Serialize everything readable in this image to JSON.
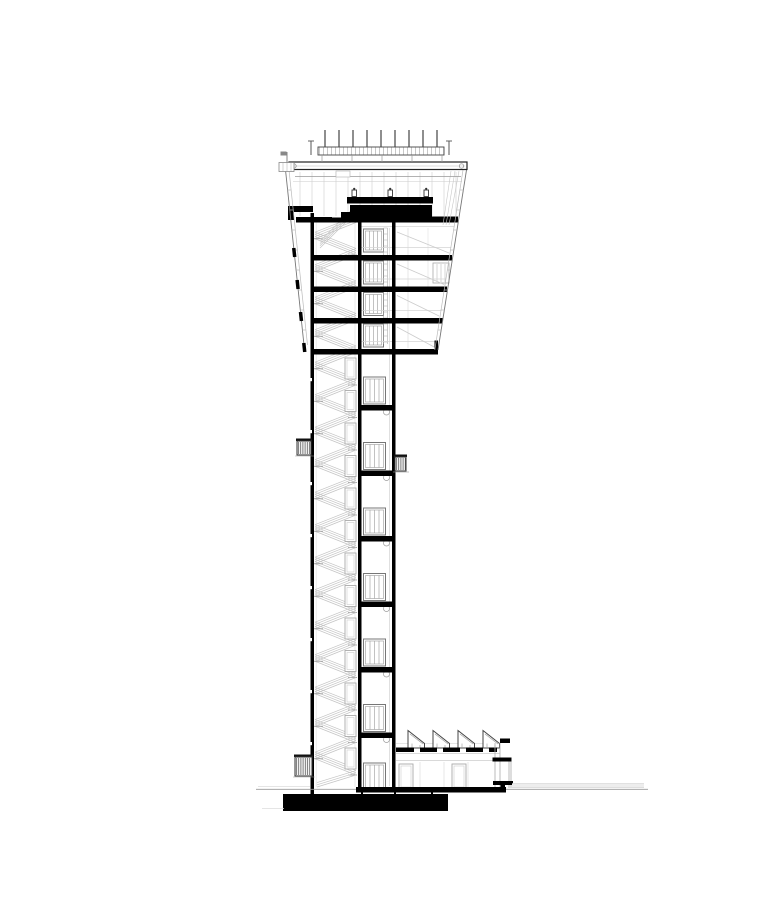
{
  "meta": {
    "description": "Architectural cross-section drawing of an airport air-traffic control tower",
    "drawing_type": "building section elevation",
    "background_color": "#ffffff",
    "ink_color": "#000000"
  },
  "drawing": {
    "canvas": {
      "w": 778,
      "h": 900
    },
    "colors": {
      "ink": "#000000",
      "line": "#333333",
      "mid": "#888888",
      "light": "#bbbbbb",
      "faint": "#dddddd"
    },
    "antenna": {
      "count": 9,
      "x0": 325,
      "dx": 14,
      "y_top": 130,
      "y_bot": 148,
      "band": {
        "x": 318,
        "y": 147,
        "w": 126,
        "h": 8,
        "tick_dx": 4
      },
      "legs": [
        322,
        352,
        382,
        412,
        442
      ],
      "end_posts": [
        311,
        449
      ]
    },
    "cab": {
      "mullion_x0": 300,
      "mullion_dx": 12,
      "mullion_count": 14,
      "mullion_y1": 172,
      "mullion_y2": 216,
      "console_monitors_x": [
        352,
        388,
        424
      ]
    },
    "facades": {
      "left": {
        "x_ref": 285.5,
        "y_ref": 170,
        "slope": 0.1057,
        "y_end": 345,
        "inner_offset": 3.5
      },
      "right": {
        "x_ref": 466.5,
        "y_ref": 170,
        "slope": -0.1583,
        "y_end": 350,
        "inner_offset": -3.5
      },
      "tick_ys": [
        190,
        210,
        230,
        250,
        270,
        290,
        310,
        330
      ]
    },
    "head": {
      "floors": [
        {
          "y": 255,
          "x1": 314,
          "x2": 452
        },
        {
          "y": 286.5,
          "x1": 314,
          "x2": 447
        },
        {
          "y": 318,
          "x1": 314,
          "x2": 442.5
        },
        {
          "y": 349,
          "x1": 314,
          "x2": 438
        }
      ],
      "elevator_doors_y": [
        229,
        261,
        292.5,
        324
      ],
      "door": {
        "x": 363.5,
        "w": 20,
        "h": 23
      },
      "ceilings_y": [
        226.5,
        247.5,
        279,
        310.5,
        341.5
      ],
      "braces": [
        [
          229,
          255
        ],
        [
          261,
          286.5
        ],
        [
          292.5,
          318
        ],
        [
          324,
          349
        ]
      ],
      "spandrels_y": [
        248,
        280,
        312,
        343
      ],
      "ladder": {
        "x1": 383.5,
        "x2": 387.5,
        "y1": 228,
        "y2": 344,
        "rung_dy": 6
      },
      "window": {
        "x": 433,
        "y": 263,
        "w": 16,
        "h": 20
      }
    },
    "shaft": {
      "stories": 17,
      "y0": 222.5,
      "story_h": 32.5,
      "x_left": 315,
      "x_right": 356,
      "tread_lines": 4,
      "tread_gap": 2.2,
      "slabs_y": [
        405,
        470.5,
        536,
        601.5,
        667,
        732.5
      ],
      "elevator_doors_y": [
        377,
        442.5,
        508,
        573.5,
        639,
        704.5,
        763
      ],
      "door": {
        "x": 363.5,
        "w": 22,
        "h": 27
      },
      "stair_doors_y": [
        358,
        390.5,
        423,
        455.5,
        488,
        520.5,
        553,
        585.5,
        618,
        650.5,
        683,
        715.5,
        748
      ],
      "stair_door": {
        "x": 345,
        "w": 11,
        "h": 21
      },
      "wall_joints_y": [
        378,
        430,
        482,
        534,
        586,
        638,
        690,
        742
      ],
      "circles_y": [
        412,
        477.5,
        543,
        608.5,
        674,
        739.5
      ]
    },
    "annex": {
      "sawtooth": {
        "count": 4,
        "x0": 408,
        "dx": 25,
        "w": 16.5,
        "h": 17.5,
        "y_base": 748
      },
      "roof_dashes": [
        [
          396,
          414
        ],
        [
          420,
          437
        ],
        [
          443,
          460
        ],
        [
          466,
          483
        ],
        [
          489,
          497
        ]
      ],
      "doors_x": [
        399,
        452
      ],
      "door": {
        "y": 764,
        "w": 14,
        "h": 25
      },
      "wall_lines_x": [
        420,
        444,
        468
      ]
    },
    "service_boxes": [
      {
        "x": 297,
        "y": 441,
        "w": 14,
        "h": 14
      },
      {
        "x": 395,
        "y": 457,
        "w": 11,
        "h": 14
      },
      {
        "x": 295,
        "y": 757,
        "w": 17,
        "h": 19
      }
    ]
  }
}
